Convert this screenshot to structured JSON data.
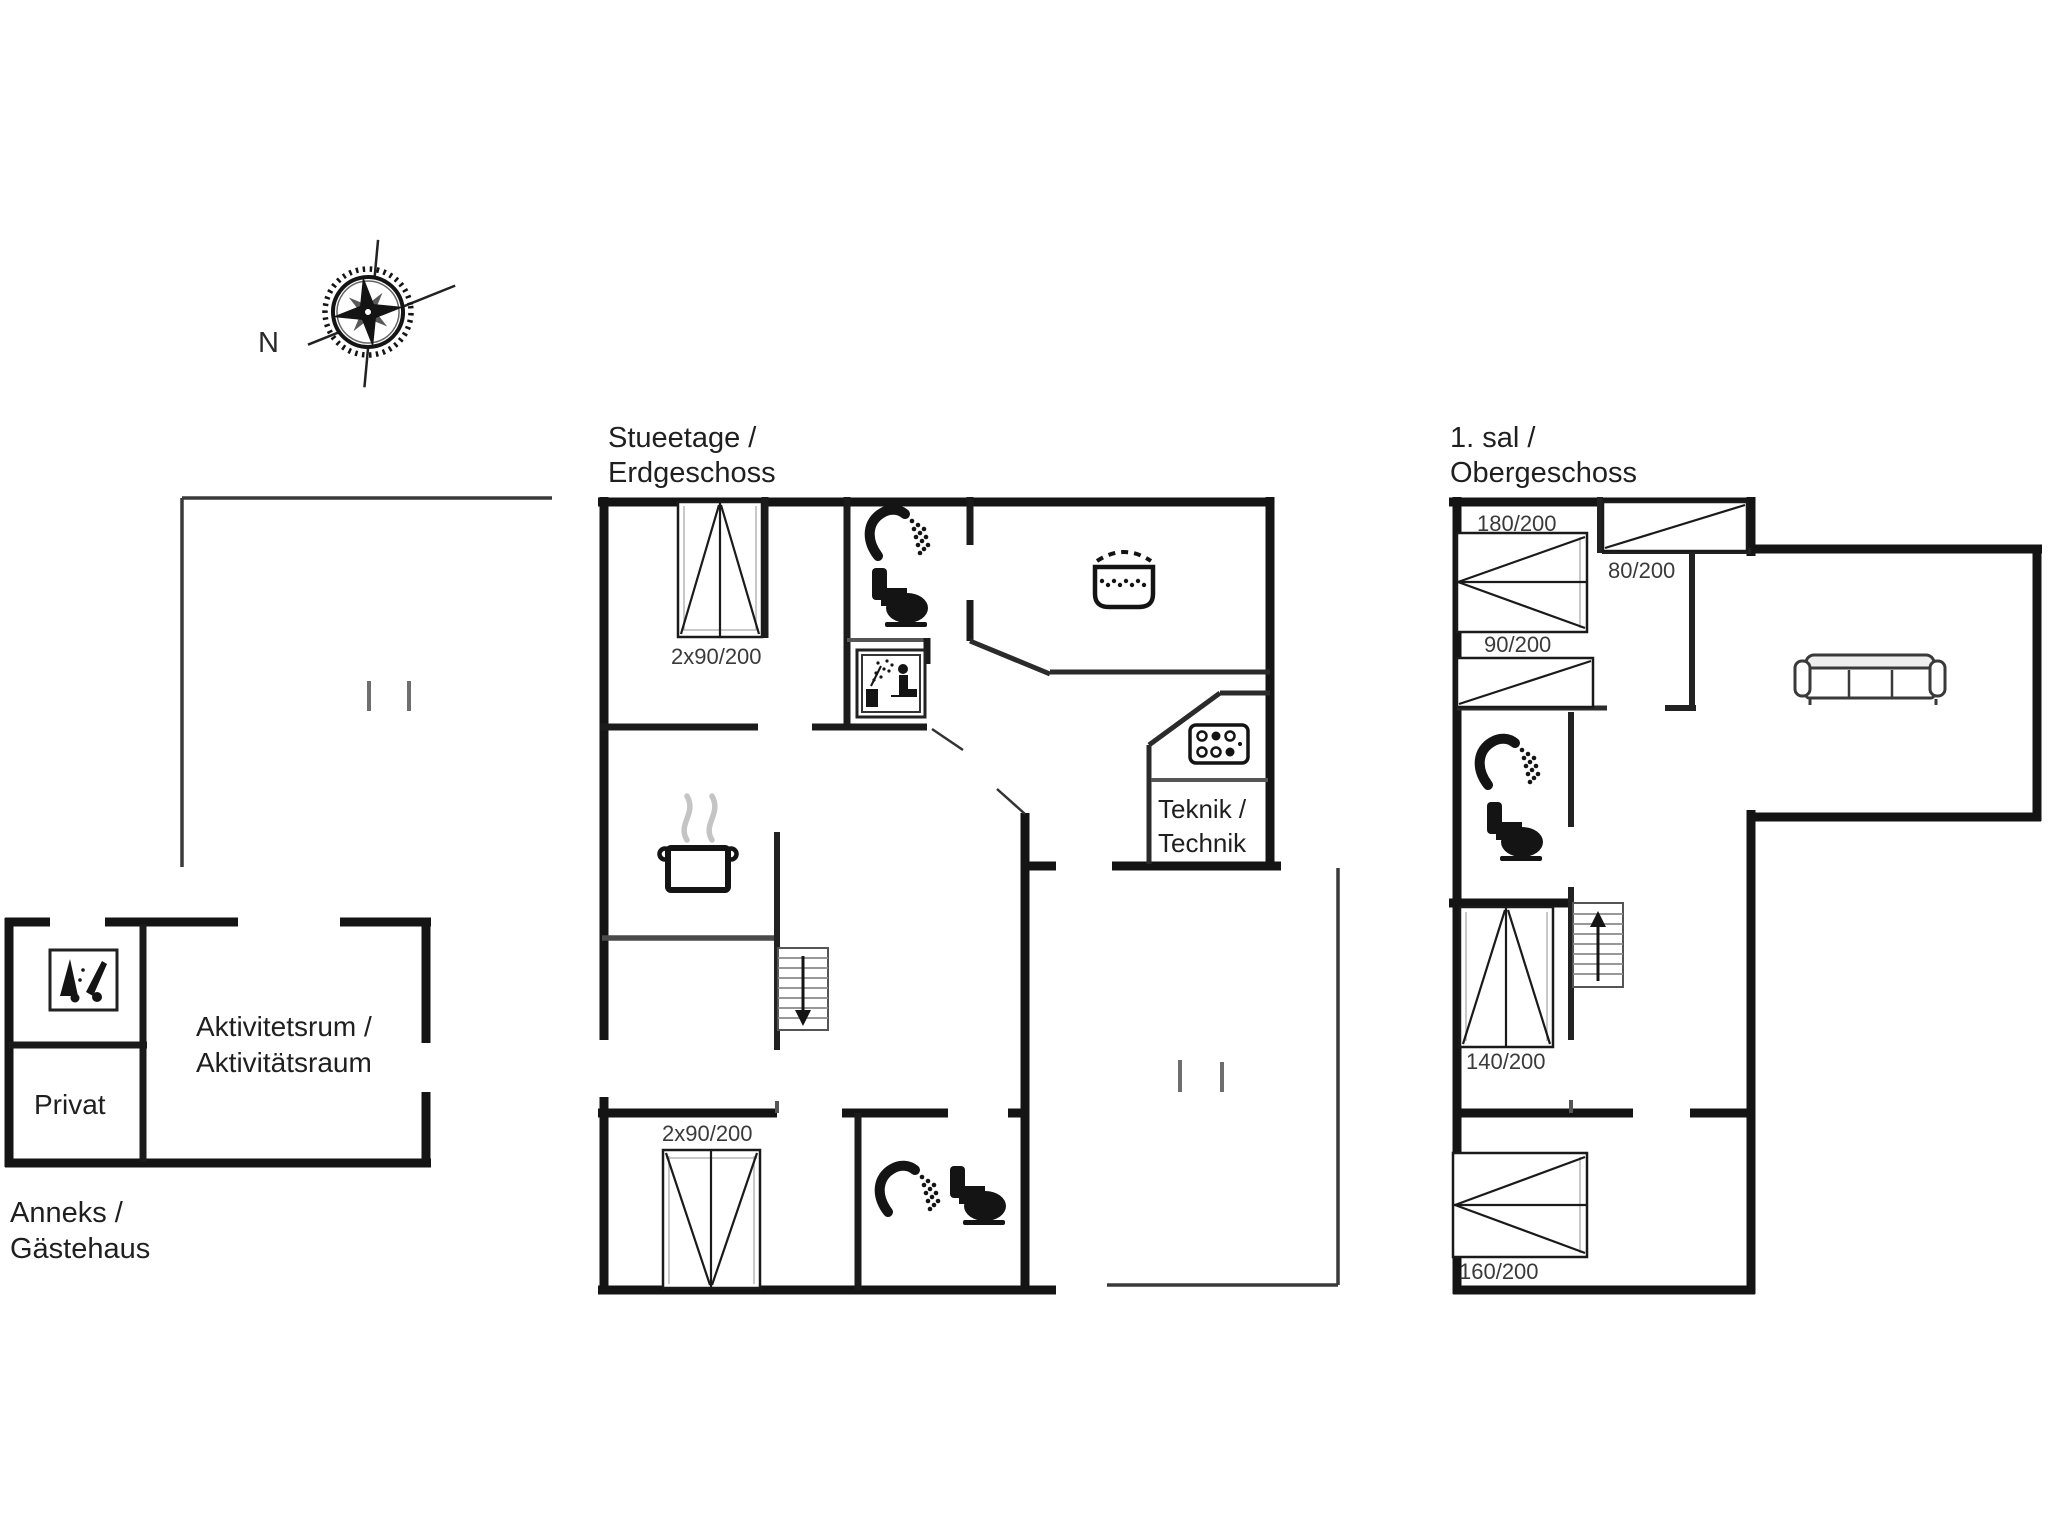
{
  "compass": {
    "north": "N"
  },
  "ground_floor": {
    "title": {
      "line1": "Stueetage /",
      "line2": "Erdgeschoss"
    },
    "teknik_room": {
      "line1": "Teknik /",
      "line2": "Technik"
    },
    "bed_top_label": "2x90/200",
    "bed_bottom_label": "2x90/200"
  },
  "first_floor": {
    "title": {
      "line1": "1. sal /",
      "line2": "Obergeschoss"
    },
    "bed_180_label": "180/200",
    "bed_80_label": "80/200",
    "bed_90_label": "90/200",
    "bed_140_label": "140/200",
    "bed_160_label": "160/200"
  },
  "annex": {
    "title": {
      "line1": "Anneks /",
      "line2": "Gästehaus"
    },
    "privat_label": "Privat",
    "activity_room": {
      "line1": "Aktivitetsrum /",
      "line2": "Aktivitätsraum"
    }
  },
  "icons": {
    "compass_rose": "compass-rose",
    "shower": "shower-head",
    "toilet": "toilet",
    "sauna": "sauna-cabin",
    "hot_tub": "hot-tub",
    "boiler": "technical-unit",
    "cooking_pot": "cooking-pot",
    "sofa": "three-seat-sofa",
    "stairs_down": "stairs-down-arrow",
    "stairs_up": "stairs-up-arrow",
    "cleaning": "cleaning-equipment",
    "double_bed": "double-bed",
    "single_bed": "single-bed"
  },
  "colors": {
    "wall": "#141414",
    "interior_wall": "#2b2b2b",
    "terrace_line": "#3a3a3a",
    "tick": "#6e6e6e",
    "light_detail": "#b5b5b5",
    "steam": "#c4c4c4",
    "label_text": "#1f1f1f",
    "bed_label_text": "#3a3a3a",
    "background": "#ffffff"
  }
}
